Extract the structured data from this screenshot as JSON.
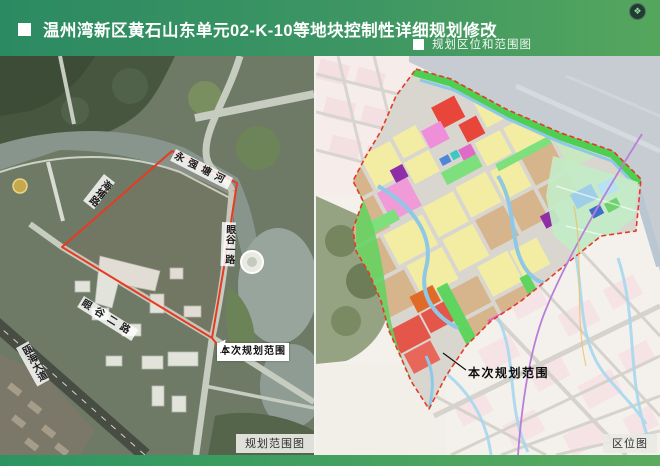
{
  "header": {
    "title": "温州湾新区黄石山东单元02-K-10等地块控制性详细规划修改",
    "section_label": "规划区位和范围图",
    "badge_glyph": "❖"
  },
  "maps": {
    "left": {
      "caption": "规划范围图",
      "callout_label": "本次规划范围",
      "labels": {
        "river": "永强塘河",
        "road_northwest": "海埔路",
        "road_east": "眼谷一路",
        "road_south": "眼谷二路",
        "road_southwest": "瓯海大道"
      }
    },
    "right": {
      "caption": "区位图",
      "callout_label": "本次规划范围"
    }
  },
  "colors": {
    "header_green_dark": "#2c8a62",
    "header_green_light": "#55a65d",
    "boundary_red": "#e23b28",
    "highlight_red": "#e4564a",
    "parcel_yellow": "#f2eda2",
    "parcel_tan": "#d6b58c",
    "parcel_green": "#4ecf52",
    "water_grey": "#c6ccd2"
  }
}
